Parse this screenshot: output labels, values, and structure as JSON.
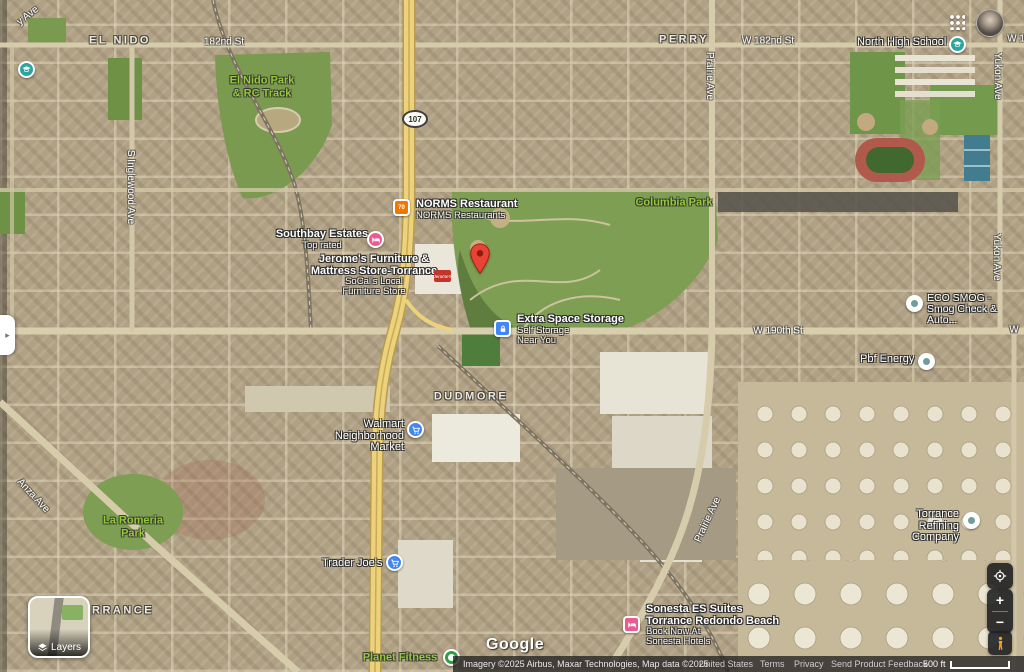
{
  "colors": {
    "pin_red": "#EA4335",
    "marker_blue": "#4285F4",
    "marker_pink": "#EA5C8F",
    "marker_green": "#2F9E44",
    "marker_teal": "#2BA59E",
    "marker_orange": "#F07800",
    "park_label_green": "#95C83D",
    "highway_yellow": "#ECD27C"
  },
  "map_labels": {
    "neighborhoods": {
      "el_nido": "EL NIDO",
      "perry": "PERRY",
      "dudmore": "DUDMORE",
      "torrance": "TORRANCE"
    },
    "streets": {
      "s182nd": "182nd St",
      "w182nd": "W 182nd St",
      "w182nd_edge": "W 1",
      "w190th": "W 190th St",
      "w190th_edge": "W",
      "prairie_top": "Prairie Ave",
      "prairie_bottom": "Prairie Ave",
      "yukon_top": "Yukon Ave",
      "yukon_mid": "Yukon Ave",
      "inglewood": "S Inglewood Ave",
      "anza": "Anza Ave",
      "corner_ave": "y Ave"
    },
    "parks": {
      "el_nido_park": [
        "El Nido Park",
        "& RC Track"
      ],
      "columbia": "Columbia Park",
      "la_romeria": [
        "La Romeria",
        "Park"
      ],
      "planet_fitness": "Planet Fitness"
    },
    "route_shield": "107"
  },
  "pois": {
    "norms": {
      "title": "NORMS Restaurant",
      "subtitle": "NORMS Restaurants",
      "icon_text": "70"
    },
    "southbay": {
      "title": "Southbay Estates",
      "subtitle": "Top rated"
    },
    "jeromes": {
      "line1": "Jerome's Furniture &",
      "line2": "Mattress Store-Torrance",
      "line3": "SoCal's Local",
      "line4": "Furniture Store"
    },
    "jeromes_building": "Jerome's",
    "extra_space": {
      "title": "Extra Space Storage",
      "line2": "Self Storage",
      "line3": "Near You"
    },
    "eco_smog": {
      "line1": "ECO SMOG -",
      "line2": "Smog Check & Auto..."
    },
    "north_high": {
      "title": "North High School"
    },
    "pbf": {
      "title": "Pbf Energy"
    },
    "torrance_refining": {
      "line1": "Torrance Refining",
      "line2": "Company"
    },
    "sonesta": {
      "line1": "Sonesta ES Suites",
      "line2": "Torrance Redondo Beach",
      "line3": "Book Now At",
      "line4": "Sonesta Hotels"
    },
    "walmart": {
      "line1": "Walmart",
      "line2": "Neighborhood Market"
    },
    "trader_joes": {
      "title": "Trader Joe's"
    }
  },
  "controls": {
    "layers_label": "Layers",
    "zoom_in": "+",
    "zoom_out": "−",
    "panel_toggle": "▸"
  },
  "footer": {
    "google_logo": "Google",
    "attribution": "Imagery ©2025 Airbus, Maxar Technologies, Map data ©2025",
    "country": "United States",
    "terms": "Terms",
    "privacy": "Privacy",
    "feedback": "Send Product Feedback",
    "scale": "500 ft"
  }
}
